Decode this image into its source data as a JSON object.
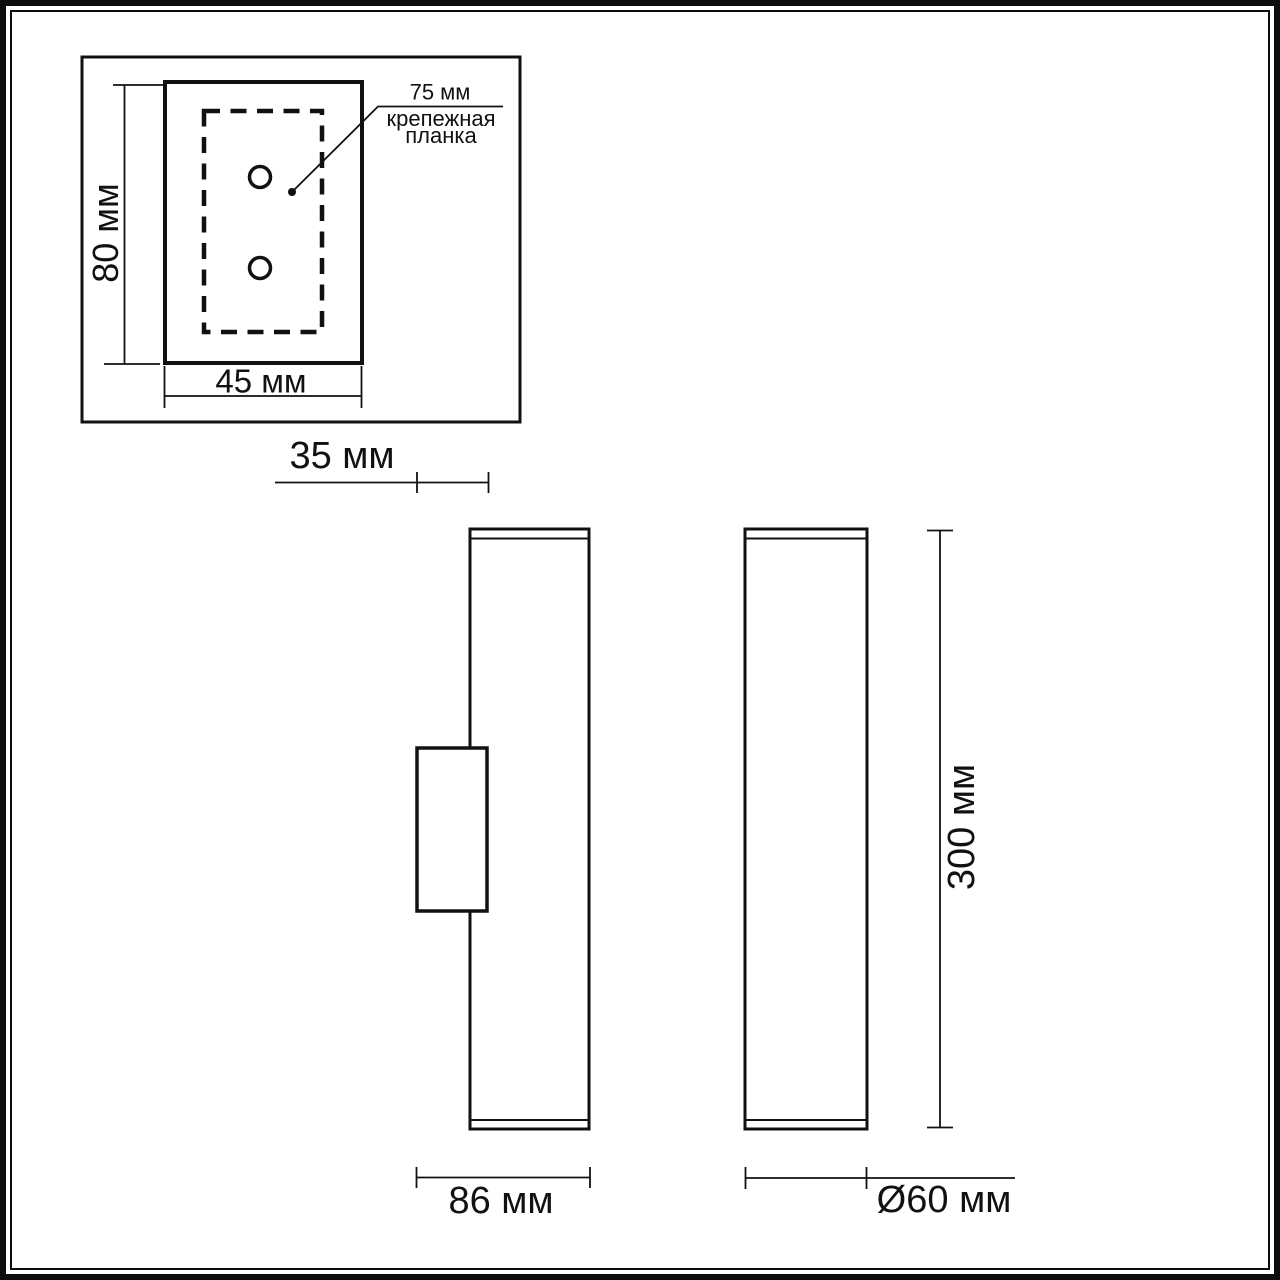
{
  "page": {
    "background": "#ffffff",
    "line_color": "#111111",
    "type": "technical-dimension-drawing"
  },
  "views": {
    "mount_plate_detail": {
      "height_dim": "80 мм",
      "width_dim": "45 мм",
      "hole_spacing_dim": "75 мм",
      "bracket_label_line1": "крепежная",
      "bracket_label_line2": "планка"
    },
    "side_view": {
      "wall_offset_dim": "35 мм",
      "depth_dim": "86 мм"
    },
    "front_view": {
      "height_dim": "300 мм",
      "diameter_dim": "Ø60 мм"
    }
  }
}
